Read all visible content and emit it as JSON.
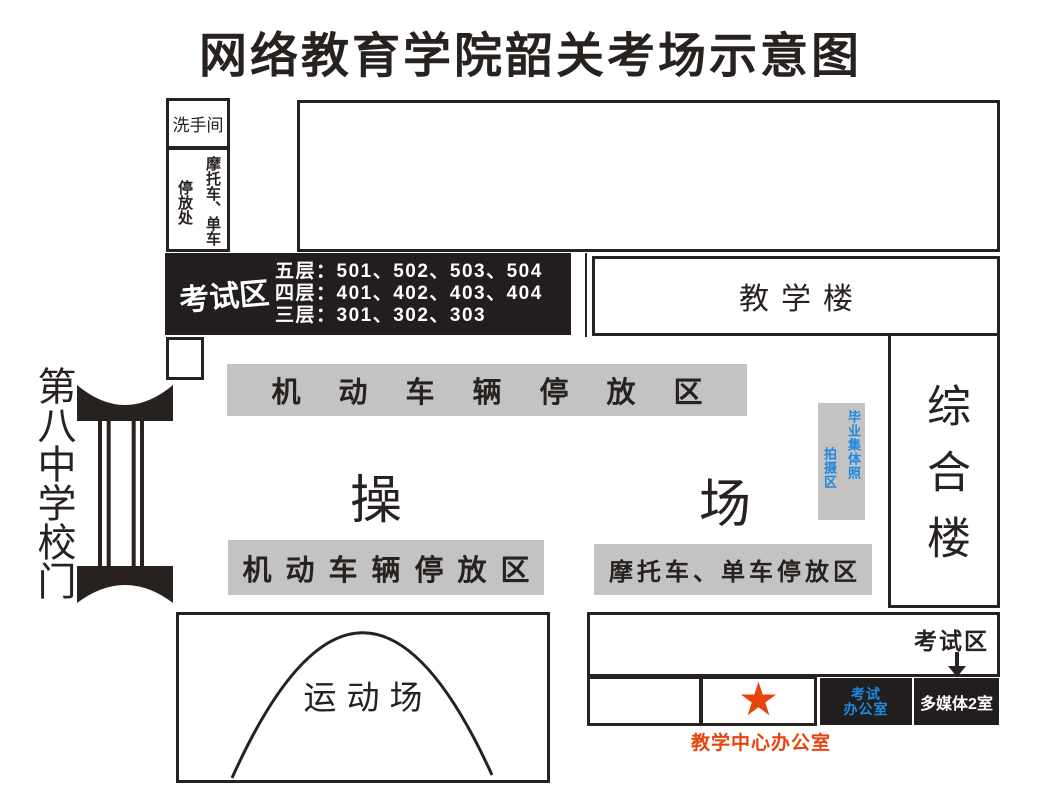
{
  "title": "网络教育学院韶关考场示意图",
  "colors": {
    "ink": "#272220",
    "block": "#221e1d",
    "gray": "#c3c3c3",
    "blue": "#1e88e0",
    "red": "#e8430c"
  },
  "map": {
    "restroom_label": "洗手间",
    "bike_shed": {
      "col_right": "摩托车、单车",
      "col_left": "停放处"
    },
    "exam_block": {
      "label": "考试区",
      "floors": [
        "五层：501、502、503、504",
        "四层：401、402、403、404",
        "三层：301、302、303"
      ]
    },
    "teaching_building_label": "教学楼",
    "complex_building_label": "综合楼",
    "upper_parking_label": "机动车辆停放区",
    "playground": {
      "char_left": "操",
      "char_right": "场"
    },
    "photo_area": {
      "col_right": "毕业集体照",
      "col_left": "拍摄区"
    },
    "lower_parking_left_label": "机动车辆停放区",
    "lower_parking_right_label": "摩托车、单车停放区",
    "school_gate_label": "第八中学校门",
    "sports_field_label": "运动场",
    "bottom_right": {
      "exam_area_label": "考试区",
      "exam_office_line1": "考试",
      "exam_office_line2": "办公室",
      "multimedia_label": "多媒体2室",
      "star": "★",
      "caption": "教学中心办公室"
    }
  }
}
